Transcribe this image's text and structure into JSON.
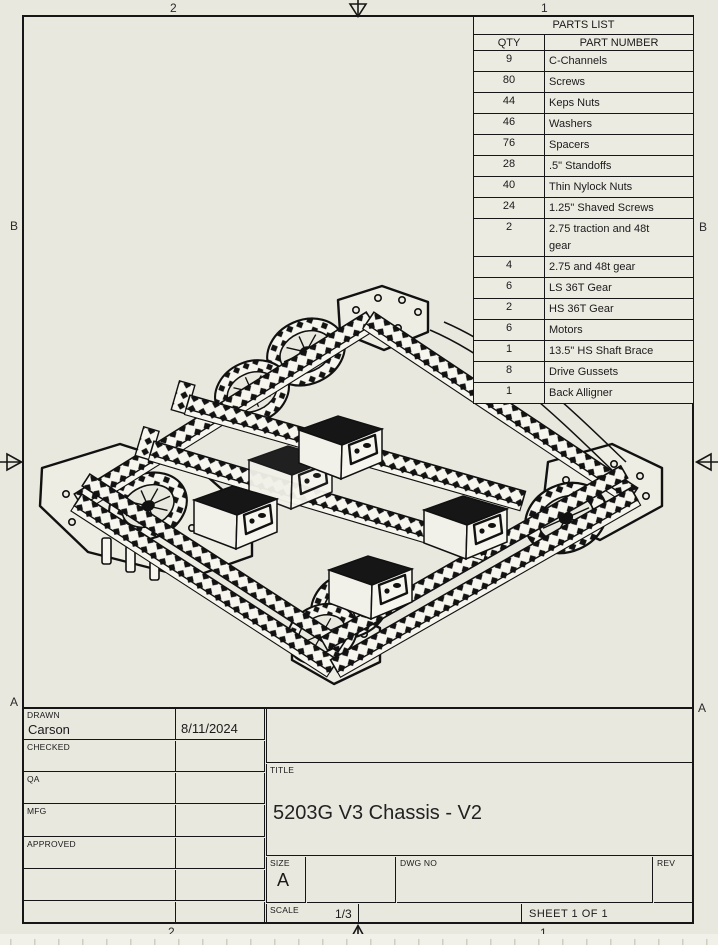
{
  "colors": {
    "paper": "#e9e8df",
    "ink": "#161616",
    "table_fill": "#ecebe2"
  },
  "zones": {
    "top_left": "2",
    "top_right": "1",
    "bottom_left": "2",
    "bottom_right": "1",
    "left_upper": "B",
    "left_lower": "A",
    "right_upper": "B",
    "right_lower": "A"
  },
  "parts_list": {
    "title": "PARTS LIST",
    "qty_header": "QTY",
    "part_header": "PART NUMBER",
    "rows": [
      {
        "qty": "9",
        "part": "C-Channels"
      },
      {
        "qty": "80",
        "part": "Screws"
      },
      {
        "qty": "44",
        "part": "Keps Nuts"
      },
      {
        "qty": "46",
        "part": "Washers"
      },
      {
        "qty": "76",
        "part": "Spacers"
      },
      {
        "qty": "28",
        "part": ".5\" Standoffs"
      },
      {
        "qty": "40",
        "part": "Thin Nylock Nuts"
      },
      {
        "qty": "24",
        "part": "1.25\" Shaved Screws"
      },
      {
        "qty": "2",
        "part": "2.75 traction and 48t\ngear"
      },
      {
        "qty": "4",
        "part": "2.75 and 48t gear"
      },
      {
        "qty": "6",
        "part": "LS 36T Gear"
      },
      {
        "qty": "2",
        "part": "HS 36T Gear"
      },
      {
        "qty": "6",
        "part": "Motors"
      },
      {
        "qty": "1",
        "part": "13.5\" HS Shaft Brace"
      },
      {
        "qty": "8",
        "part": "Drive Gussets"
      },
      {
        "qty": "1",
        "part": "Back Alligner"
      }
    ]
  },
  "title_block": {
    "drawn_label": "DRAWN",
    "drawn_name": "Carson",
    "drawn_date": "8/11/2024",
    "checked_label": "CHECKED",
    "qa_label": "QA",
    "mfg_label": "MFG",
    "approved_label": "APPROVED",
    "title_label": "TITLE",
    "title": "5203G V3 Chassis - V2",
    "size_label": "SIZE",
    "size_value": "A",
    "dwg_label": "DWG NO",
    "rev_label": "REV",
    "scale_label": "SCALE",
    "scale_value": "1/3",
    "sheet_text": "SHEET 1  OF 1"
  }
}
